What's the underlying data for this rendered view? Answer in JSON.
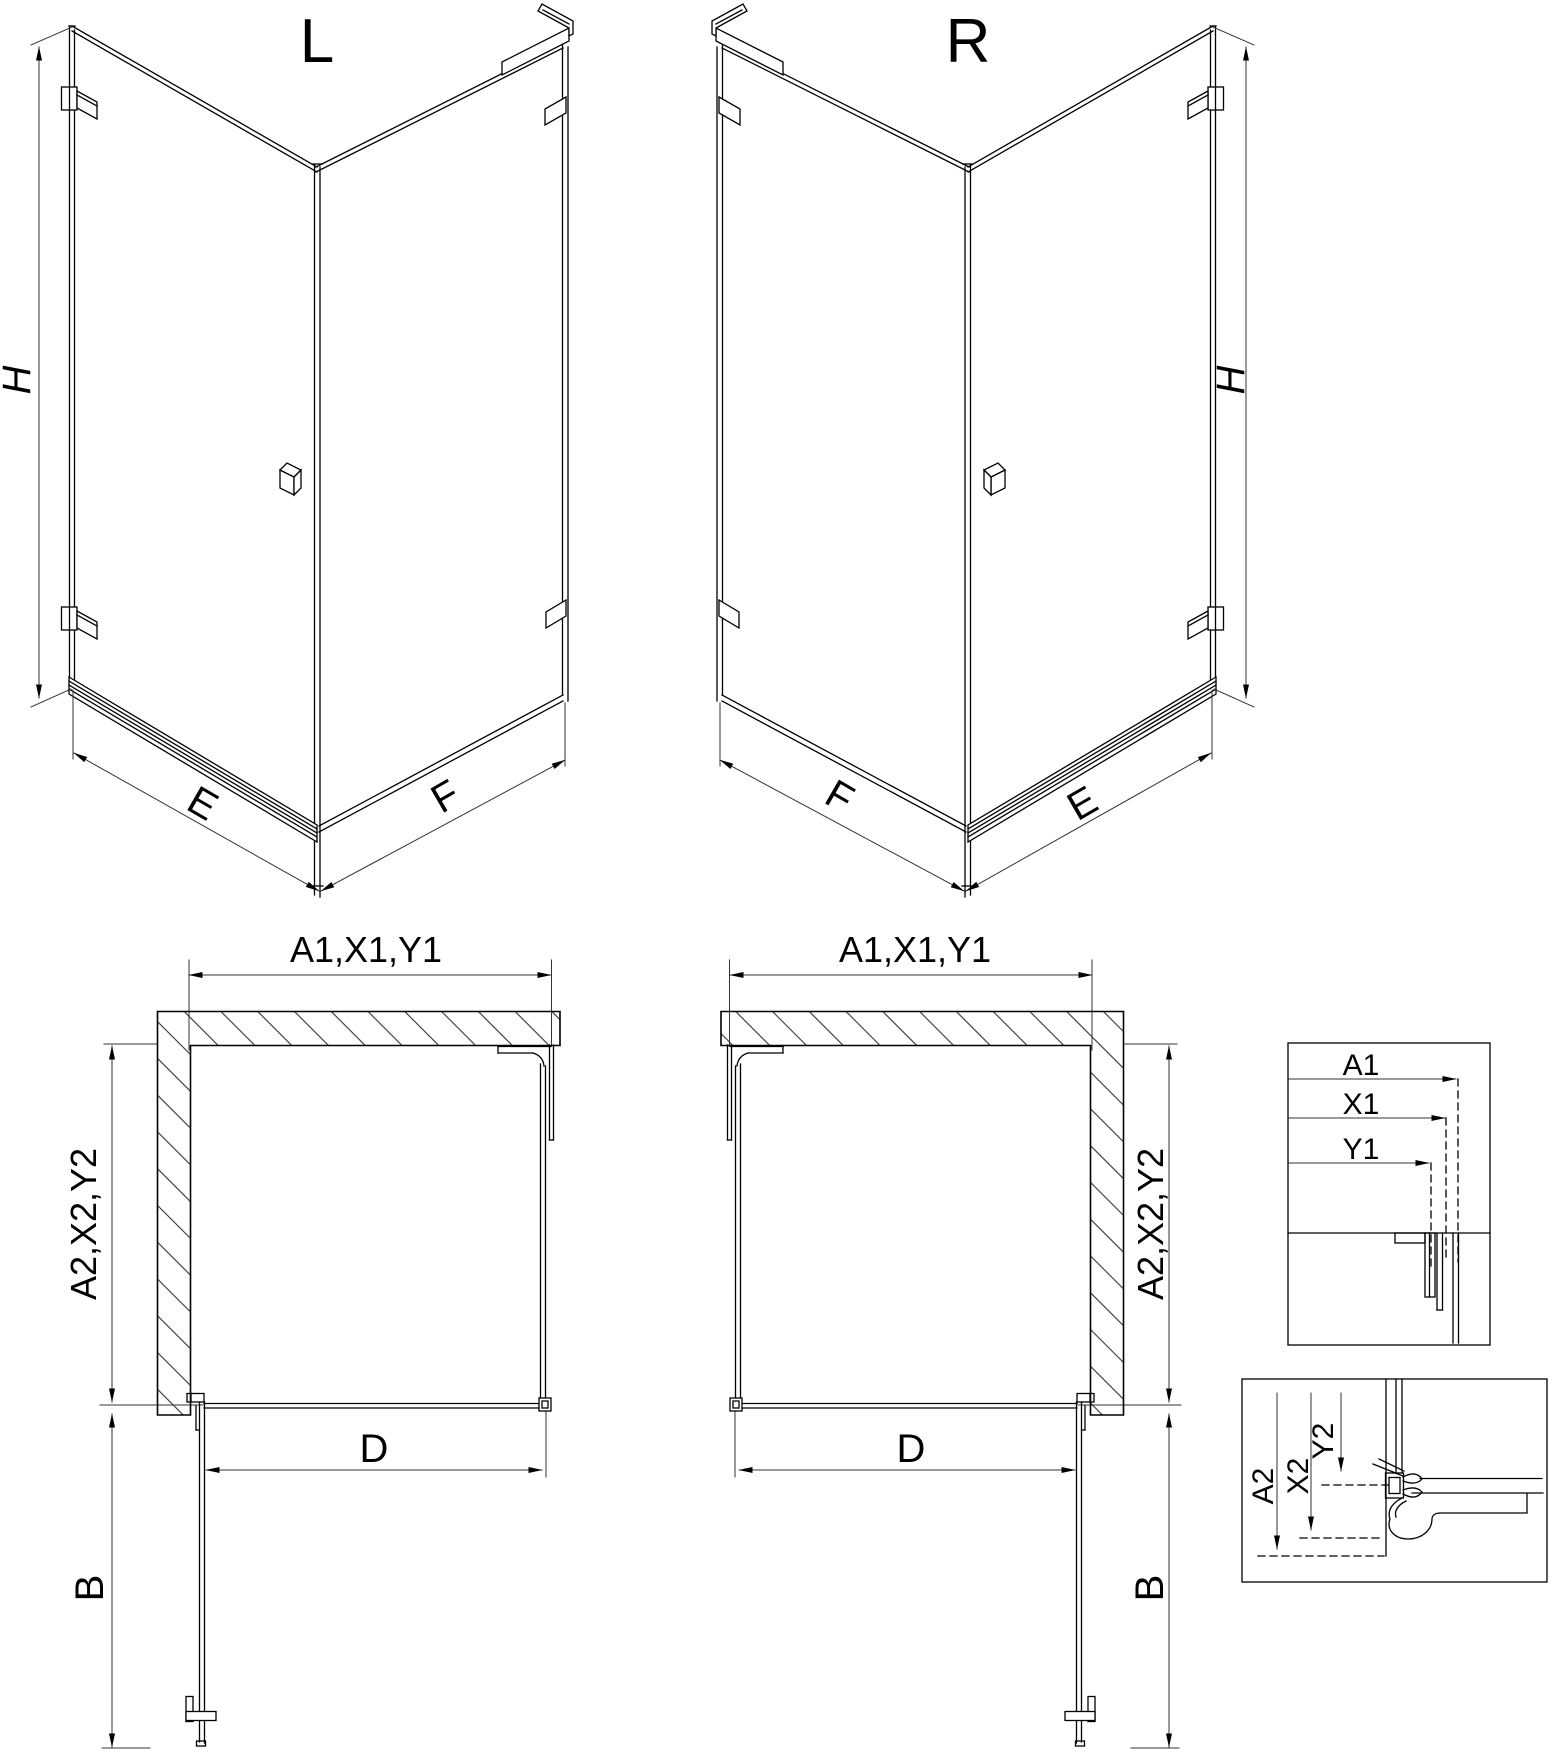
{
  "drawing": {
    "background": "#ffffff",
    "line_color": "#000000",
    "dim_line_color": "#333333",
    "views": {
      "iso_left": {
        "title": "L",
        "height_dim": "H",
        "left_width_dim": "E",
        "right_width_dim": "F"
      },
      "iso_right": {
        "title": "R",
        "height_dim": "H",
        "left_width_dim": "F",
        "right_width_dim": "E"
      },
      "plan_left": {
        "width_dim": "A1,X1,Y1",
        "depth_dim": "A2,X2,Y2",
        "entry_dim": "D",
        "door_swing_dim": "B"
      },
      "plan_right": {
        "width_dim": "A1,X1,Y1",
        "depth_dim": "A2,X2,Y2",
        "entry_dim": "D",
        "door_swing_dim": "B"
      },
      "detail_width": {
        "dims": [
          "A1",
          "X1",
          "Y1"
        ]
      },
      "detail_depth": {
        "dims": [
          "A2",
          "X2",
          "Y2"
        ]
      }
    }
  }
}
